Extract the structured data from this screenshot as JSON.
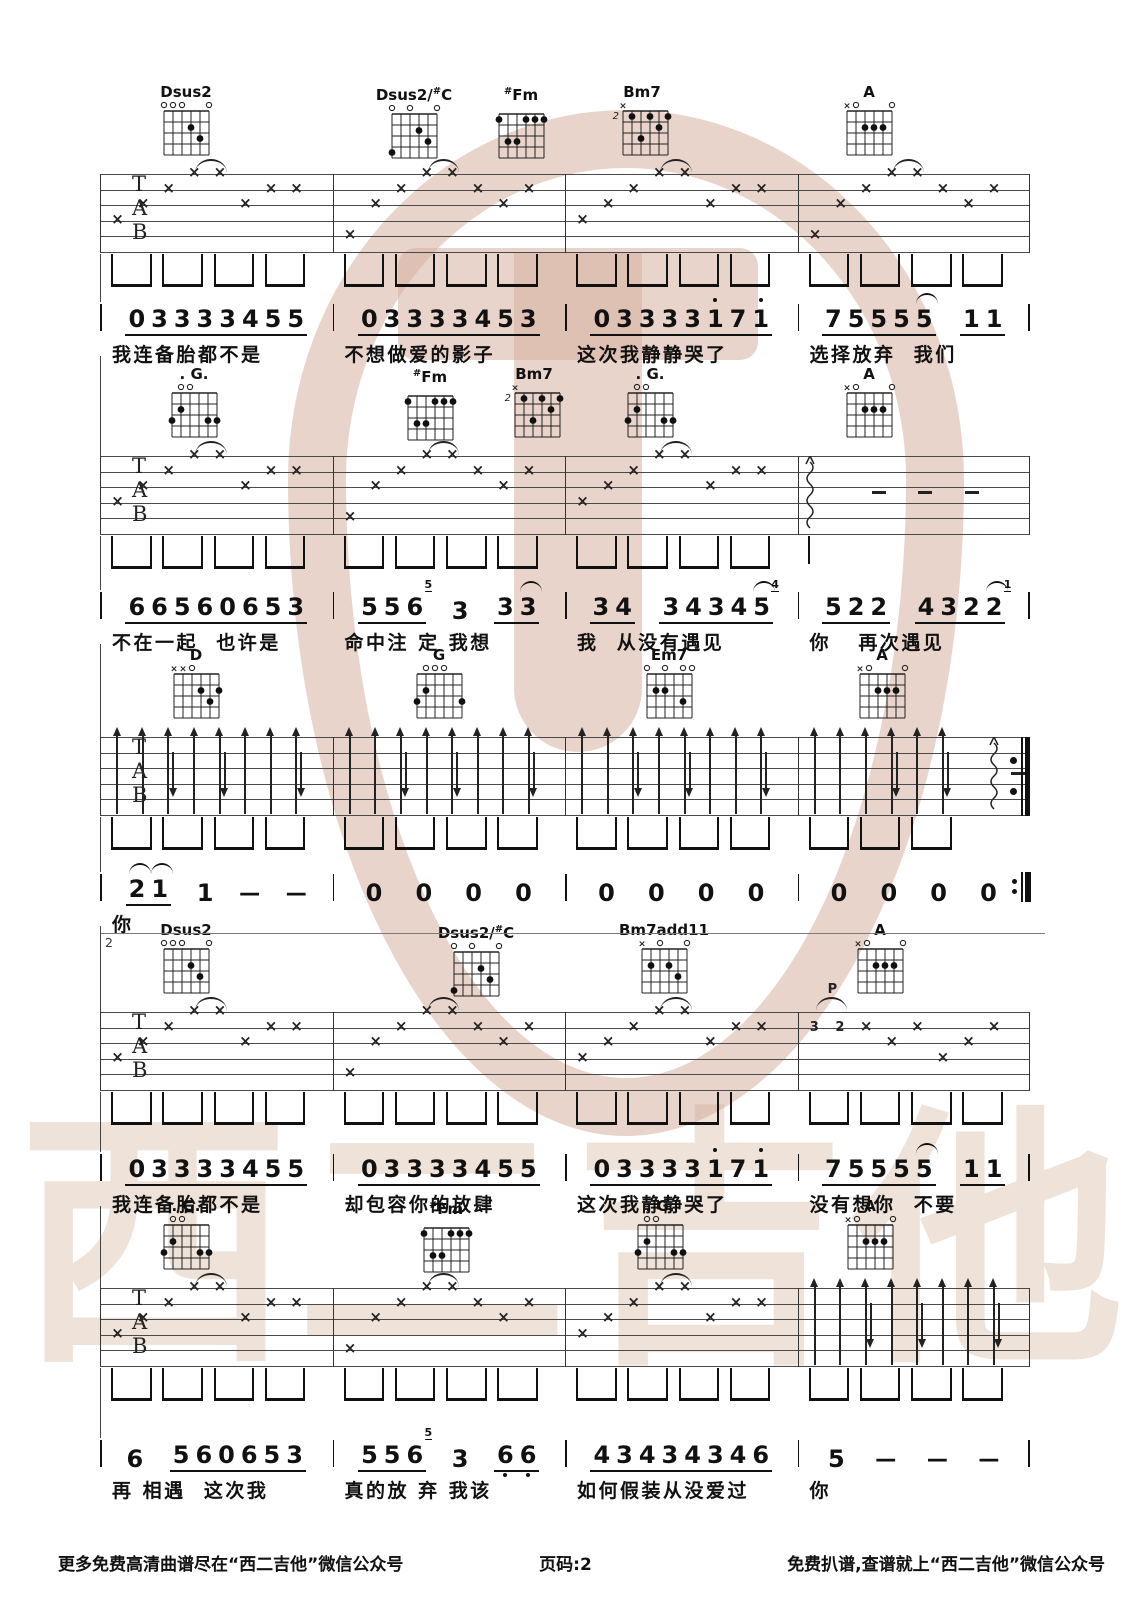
{
  "page": {
    "width": 1131,
    "height": 1600,
    "background": "#ffffff"
  },
  "watermark": {
    "text": "西二吉他",
    "pick_color": "rgba(215,176,161,0.55)",
    "text_color": "rgba(206,170,143,0.34)"
  },
  "footer": {
    "left": "更多免费高清曲谱尽在“西二吉他”微信公众号",
    "center": "页码:2",
    "right": "免费扒谱,查谱就上“西二吉他”微信公众号"
  },
  "volta": {
    "label": "2"
  },
  "tab_letters": [
    "T",
    "A",
    "B"
  ],
  "chord_defs": {
    "Dsus2": {
      "label": "Dsus2",
      "mk": "ooo__o",
      "dots": [
        [
          4,
          2
        ],
        [
          5,
          3
        ]
      ]
    },
    "Dsus2C": {
      "label": "Dsus2/#C",
      "mk": "o_o__o",
      "dots": [
        [
          4,
          2
        ],
        [
          5,
          3
        ],
        [
          1,
          4
        ]
      ]
    },
    "Fsm": {
      "label": "#Fm",
      "mk": "______",
      "dots": [
        [
          1,
          1
        ],
        [
          4,
          1
        ],
        [
          5,
          1
        ],
        [
          6,
          1
        ],
        [
          2,
          3
        ],
        [
          3,
          3
        ]
      ]
    },
    "Bm7": {
      "label": "Bm7",
      "mk": "x_____",
      "fret": "2",
      "dots": [
        [
          2,
          1
        ],
        [
          4,
          1
        ],
        [
          6,
          1
        ],
        [
          5,
          2
        ],
        [
          3,
          3
        ]
      ]
    },
    "A": {
      "label": "A",
      "mk": "xo___o",
      "dots": [
        [
          3,
          2
        ],
        [
          4,
          2
        ],
        [
          5,
          2
        ]
      ]
    },
    "Gd": {
      "label": ". G.",
      "mk": "_oo___",
      "dots": [
        [
          2,
          2
        ],
        [
          1,
          3
        ],
        [
          5,
          3
        ],
        [
          6,
          3
        ]
      ]
    },
    "D": {
      "label": "D",
      "mk": "xxo___",
      "dots": [
        [
          4,
          2
        ],
        [
          6,
          2
        ],
        [
          5,
          3
        ]
      ]
    },
    "G": {
      "label": "G",
      "mk": "_ooo__",
      "dots": [
        [
          2,
          2
        ],
        [
          1,
          3
        ],
        [
          6,
          3
        ]
      ]
    },
    "Em7": {
      "label": "Em7",
      "mk": "o_o_oo",
      "dots": [
        [
          2,
          2
        ],
        [
          3,
          2
        ],
        [
          5,
          3
        ]
      ]
    },
    "Bm7add11": {
      "label": "Bm7add11",
      "mk": "x_o__o",
      "dots": [
        [
          2,
          2
        ],
        [
          4,
          2
        ],
        [
          5,
          3
        ]
      ]
    }
  },
  "patterns": {
    "a": {
      "marks": [
        [
          1,
          4
        ],
        [
          2,
          3
        ],
        [
          3,
          2
        ],
        [
          4,
          1
        ],
        [
          5,
          1
        ],
        [
          6,
          3
        ],
        [
          7,
          2
        ],
        [
          8,
          2
        ]
      ],
      "arc": [
        4,
        5
      ],
      "stems": "u4"
    },
    "b": {
      "marks": [
        [
          1,
          5
        ],
        [
          2,
          3
        ],
        [
          3,
          2
        ],
        [
          4,
          1
        ],
        [
          5,
          1
        ],
        [
          6,
          2
        ],
        [
          7,
          3
        ],
        [
          8,
          2
        ]
      ],
      "arc": [
        4,
        5
      ],
      "stems": "u4"
    },
    "s": {
      "ups": [
        1,
        2,
        3,
        4,
        5,
        6,
        7,
        8
      ],
      "downs": [
        3,
        5,
        8
      ],
      "stems": "u4"
    },
    "send": {
      "ups": [
        1,
        2,
        3,
        4,
        5,
        6
      ],
      "downs": [
        4,
        6
      ],
      "wavy": 0.82,
      "dash": [
        0.92
      ],
      "stems": "u3"
    },
    "arp": {
      "wavy": 0.03,
      "dash": [
        0.32,
        0.52,
        0.72
      ],
      "stems": "single"
    },
    "pull": {
      "label": "P",
      "nums": [
        [
          "3",
          1,
          2
        ],
        [
          "2",
          2,
          2
        ]
      ],
      "arc": [
        1,
        2
      ],
      "marks": [
        [
          3,
          2
        ],
        [
          4,
          3
        ],
        [
          5,
          2
        ],
        [
          6,
          4
        ],
        [
          7,
          3
        ],
        [
          8,
          2
        ]
      ],
      "stems": "u4"
    }
  },
  "systems": [
    {
      "staff_top": 174,
      "measures": [
        "a",
        "b",
        "a",
        "b"
      ],
      "chords": [
        {
          "c": "Dsus2",
          "x": 162
        },
        {
          "c": "Dsus2C",
          "x": 390
        },
        {
          "c": "Fsm",
          "x": 497
        },
        {
          "c": "Bm7",
          "x": 618
        },
        {
          "c": "A",
          "x": 845
        }
      ]
    },
    {
      "staff_top": 456,
      "measures": [
        "a",
        "b",
        "a",
        "arp"
      ],
      "chords": [
        {
          "c": "Gd",
          "x": 170
        },
        {
          "c": "Fsm",
          "x": 406
        },
        {
          "c": "Bm7",
          "x": 510
        },
        {
          "c": "Gd",
          "x": 626
        },
        {
          "c": "A",
          "x": 845
        }
      ]
    },
    {
      "staff_top": 737,
      "measures": [
        "s",
        "s",
        "s",
        "send"
      ],
      "end": "repeat",
      "chords": [
        {
          "c": "D",
          "x": 172
        },
        {
          "c": "G",
          "x": 415
        },
        {
          "c": "Em7",
          "x": 645
        },
        {
          "c": "A",
          "x": 858
        }
      ]
    },
    {
      "staff_top": 1012,
      "measures": [
        "a",
        "b",
        "a",
        "pull"
      ],
      "chords": [
        {
          "c": "Dsus2",
          "x": 162
        },
        {
          "c": "Dsus2C",
          "x": 452
        },
        {
          "c": "Bm7add11",
          "x": 640
        },
        {
          "c": "A",
          "x": 856
        }
      ]
    },
    {
      "staff_top": 1288,
      "measures": [
        "a",
        "b",
        "a",
        "s"
      ],
      "chords": [
        {
          "c": "Gd",
          "x": 162
        },
        {
          "c": "Fsm",
          "x": 422
        },
        {
          "c": "Gd",
          "x": 636
        },
        {
          "c": "A",
          "x": 846
        }
      ]
    }
  ],
  "jianpu_rows": [
    {
      "y": 300,
      "measures": [
        {
          "g": [
            {
              "b": 1,
              "n": [
                "0",
                "3",
                "3",
                "3",
                "3",
                "4",
                "5",
                "5"
              ]
            }
          ],
          "ly": "我连备胎都不是"
        },
        {
          "g": [
            {
              "b": 1,
              "n": [
                "0",
                "3",
                "3",
                "3",
                "3",
                "4",
                "5",
                "3"
              ]
            }
          ],
          "ly": "不想做爱的影子"
        },
        {
          "g": [
            {
              "b": 1,
              "n": [
                "0",
                "3",
                "3",
                "3",
                "3",
                "1'",
                "7",
                "1'"
              ]
            }
          ],
          "ly": "这次我静静哭了"
        },
        {
          "g": [
            {
              "b": 1,
              "n": [
                "7",
                "5",
                "5",
                "5",
                "5~"
              ]
            },
            {
              "b": 1,
              "n": [
                "1",
                "1"
              ]
            }
          ],
          "ly": "选择放弃  我们"
        }
      ]
    },
    {
      "y": 588,
      "measures": [
        {
          "g": [
            {
              "b": 1,
              "n": [
                "6",
                "6",
                "5",
                "6",
                "0",
                "6",
                "5",
                "3"
              ]
            }
          ],
          "ly": "不在一起  也许是"
        },
        {
          "g": [
            {
              "b": 1,
              "n": [
                "5",
                "5",
                "6^5"
              ]
            },
            {
              "b": 0,
              "n": [
                "3"
              ]
            },
            {
              "b": 1,
              "n": [
                "3",
                "3~"
              ]
            }
          ],
          "ly": "命中注 定 我想"
        },
        {
          "g": [
            {
              "b": 1,
              "n": [
                "3",
                "4"
              ]
            },
            {
              "b": 1,
              "n": [
                "3",
                "4",
                "3",
                "4",
                "5^4~"
              ]
            }
          ],
          "ly": "我  从没有遇见"
        },
        {
          "g": [
            {
              "b": 1,
              "n": [
                "5",
                "2",
                "2"
              ]
            },
            {
              "b": 1,
              "n": [
                "4",
                "3",
                "2",
                "2^1~"
              ]
            }
          ],
          "ly": "你   再次遇见"
        }
      ]
    },
    {
      "y": 870,
      "end": "repeat",
      "measures": [
        {
          "g": [
            {
              "b": 1,
              "n": [
                "2~",
                "1~"
              ]
            },
            {
              "b": 0,
              "n": [
                "1"
              ]
            },
            {
              "b": 0,
              "n": [
                "-"
              ]
            },
            {
              "b": 0,
              "n": [
                "-"
              ]
            }
          ],
          "ly": "你"
        },
        {
          "g": [
            {
              "b": 0,
              "n": [
                "0"
              ]
            },
            {
              "b": 0,
              "n": [
                "0"
              ]
            },
            {
              "b": 0,
              "n": [
                "0"
              ]
            },
            {
              "b": 0,
              "n": [
                "0"
              ]
            }
          ],
          "ly": ""
        },
        {
          "g": [
            {
              "b": 0,
              "n": [
                "0"
              ]
            },
            {
              "b": 0,
              "n": [
                "0"
              ]
            },
            {
              "b": 0,
              "n": [
                "0"
              ]
            },
            {
              "b": 0,
              "n": [
                "0"
              ]
            }
          ],
          "ly": ""
        },
        {
          "g": [
            {
              "b": 0,
              "n": [
                "0"
              ]
            },
            {
              "b": 0,
              "n": [
                "0"
              ]
            },
            {
              "b": 0,
              "n": [
                "0"
              ]
            },
            {
              "b": 0,
              "n": [
                "0"
              ]
            }
          ],
          "ly": ""
        }
      ]
    },
    {
      "y": 1150,
      "measures": [
        {
          "g": [
            {
              "b": 1,
              "n": [
                "0",
                "3",
                "3",
                "3",
                "3",
                "4",
                "5",
                "5"
              ]
            }
          ],
          "ly": "我连备胎都不是"
        },
        {
          "g": [
            {
              "b": 1,
              "n": [
                "0",
                "3",
                "3",
                "3",
                "3",
                "4",
                "5",
                "5"
              ]
            }
          ],
          "ly": "却包容你的放肆"
        },
        {
          "g": [
            {
              "b": 1,
              "n": [
                "0",
                "3",
                "3",
                "3",
                "3",
                "1'",
                "7",
                "1'"
              ]
            }
          ],
          "ly": "这次我静静哭了"
        },
        {
          "g": [
            {
              "b": 1,
              "n": [
                "7",
                "5",
                "5",
                "5",
                "5~"
              ]
            },
            {
              "b": 1,
              "n": [
                "1",
                "1"
              ]
            }
          ],
          "ly": "没有想你  不要"
        }
      ]
    },
    {
      "y": 1436,
      "measures": [
        {
          "g": [
            {
              "b": 0,
              "n": [
                "6"
              ]
            },
            {
              "b": 1,
              "n": [
                "5",
                "6",
                "0",
                "6",
                "5",
                "3"
              ]
            }
          ],
          "ly": "再 相遇  这次我"
        },
        {
          "g": [
            {
              "b": 1,
              "n": [
                "5",
                "5",
                "6^5"
              ]
            },
            {
              "b": 0,
              "n": [
                "3"
              ]
            },
            {
              "b": 1,
              "n": [
                "6,",
                "6,"
              ]
            }
          ],
          "ly": "真的放 弃 我该"
        },
        {
          "g": [
            {
              "b": 1,
              "n": [
                "4",
                "3",
                "4",
                "3",
                "4",
                "3",
                "4",
                "6"
              ]
            }
          ],
          "ly": "如何假装从没爱过"
        },
        {
          "g": [
            {
              "b": 0,
              "n": [
                "5"
              ]
            },
            {
              "b": 0,
              "n": [
                "-"
              ]
            },
            {
              "b": 0,
              "n": [
                "-"
              ]
            },
            {
              "b": 0,
              "n": [
                "-"
              ]
            }
          ],
          "ly": "你"
        }
      ]
    }
  ]
}
